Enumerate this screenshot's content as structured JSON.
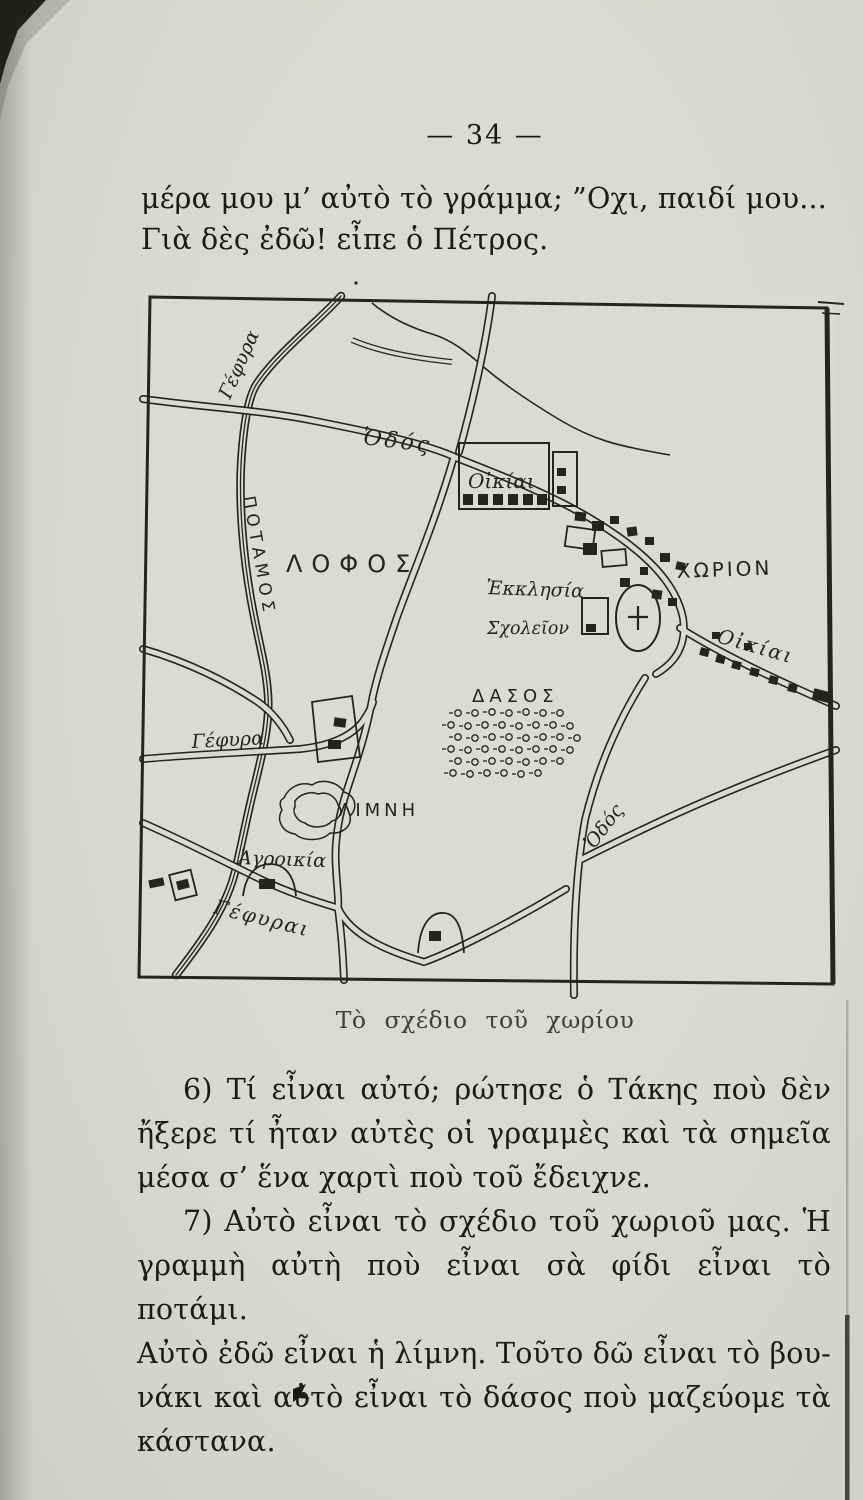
{
  "page": {
    "number_line": "— 34 —",
    "top_paragraph": {
      "lines": [
        "μέρα μου μ’ αὐτὸ τὸ γράμμα; ”Οχι, παιδί μου...",
        "Γιὰ δὲς ἐδῶ! εἶπε ὁ Πέτρος."
      ]
    },
    "caption": "Τὸ σχέδιο τοῦ χωρίου",
    "paragraph_6": {
      "lines": [
        "6)  Τί εἶναι αὐτό; ρώτησε ὁ Τάκης ποὺ δὲν",
        "ἤξερε τί ἦταν αὐτὲς οἱ γραμμὲς καὶ τὰ σημεῖα",
        "μέσα σ’ ἕνα χαρτὶ ποὺ τοῦ ἔδειχνε."
      ]
    },
    "paragraph_7": {
      "lines": [
        "7)  Αὐτὸ εἶναι τὸ σχέδιο τοῦ χωριοῦ μας. Ἡ",
        "γραμμὴ αὐτὴ ποὺ εἶναι σὰ φίδι εἶναι τὸ ποτάμι.",
        "Αὐτὸ ἐδῶ εἶναι ἡ λίμνη. Τοῦτο δῶ εἶναι τὸ βου-",
        "νάκι καὶ αὐτὸ εἶναι τὸ δάσος ποὺ μαζεύομε τὰ",
        "κάστανα."
      ]
    }
  },
  "map": {
    "labels": {
      "bridge_top": "Γέφυρα",
      "road_top": "Ὁδός",
      "river": "ΠΟΤΑΜΟΣ",
      "hill": "ΛΟΦΟΣ",
      "houses_top": "Οἰκίαι",
      "church": "Ἐκκλησία",
      "school": "Σχολεῖον",
      "village": "ΧΩΡΙΟΝ",
      "houses_right": "Οἰκίαι",
      "forest": "ΔΑΣΟΣ",
      "lake": "ΛΙΜΝΗ",
      "bridge_middle": "Γέφυρα",
      "farmhouse": "Ἀγροικία",
      "bridges_bottom": "Γέφυραι",
      "road_bottom": "Ὁδός"
    }
  },
  "colors": {
    "paper": "#d7d9d2",
    "ink": "#24251f"
  }
}
